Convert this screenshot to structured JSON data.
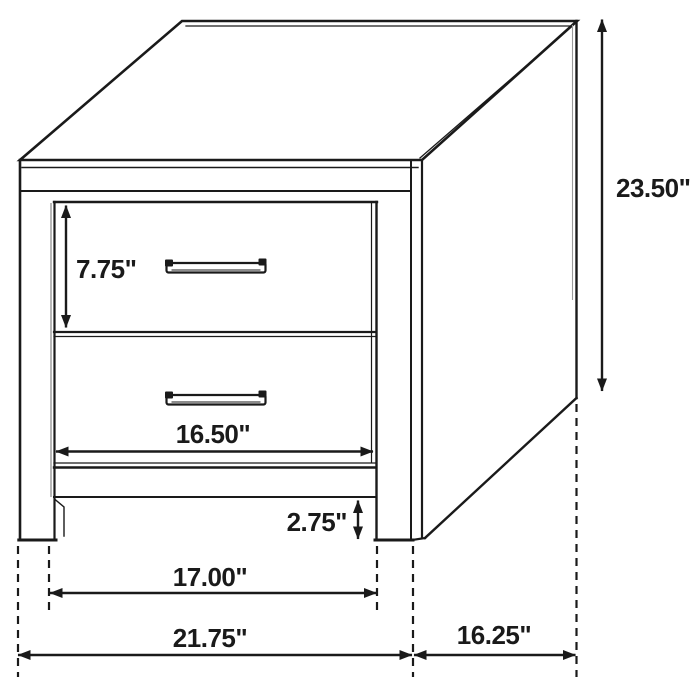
{
  "diagram": {
    "subject": "two-drawer nightstand dimension drawing",
    "background": "#ffffff",
    "line_color": "#1a1a1a",
    "unit": "inches",
    "dimensions": {
      "overall_height": "23.50\"",
      "drawer_height": "7.75\"",
      "drawer_width": "16.50\"",
      "foot_clearance": "2.75\"",
      "inner_leg_span": "17.00\"",
      "overall_width": "21.75\"",
      "side_depth": "16.25\""
    }
  }
}
